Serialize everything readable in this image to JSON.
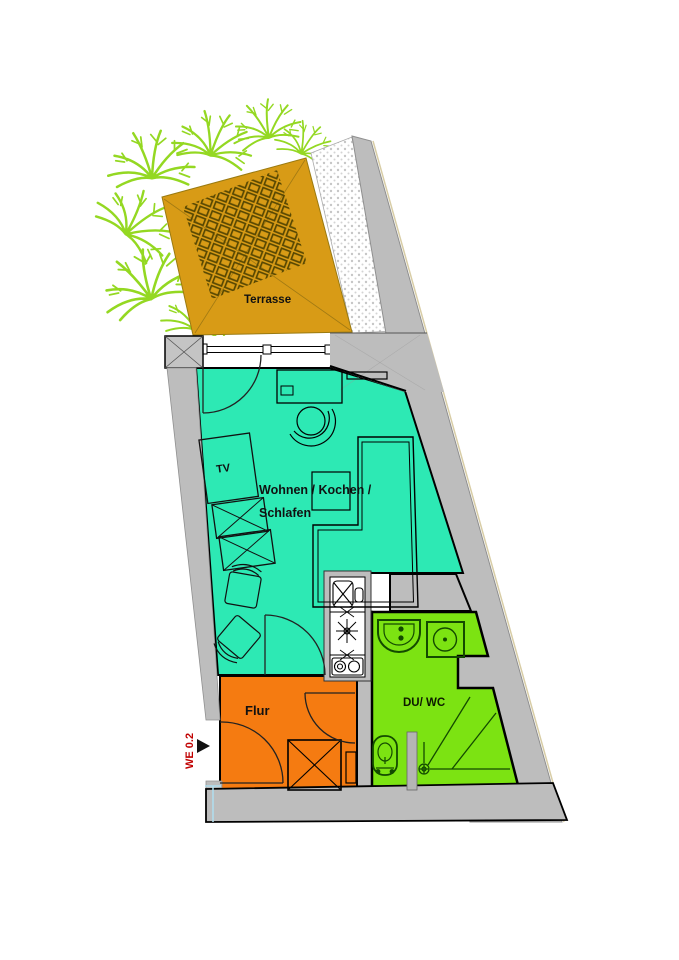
{
  "plan": {
    "unit_label": "WE 0.2",
    "rooms": {
      "terrace": "Terrasse",
      "living_line1": "Wohnen / Kochen /",
      "living_line2": "Schlafen",
      "hall": "Flur",
      "bath": "DU/ WC",
      "tv": "TV"
    },
    "colors": {
      "terrace": "#d89b16",
      "living": "#2de9b4",
      "hall": "#f57b11",
      "bath": "#7ce312",
      "plants": "#94d822",
      "wall": "#bdbdbd",
      "fixture_stroke": "#134a00",
      "unit_text": "#c00000"
    }
  }
}
